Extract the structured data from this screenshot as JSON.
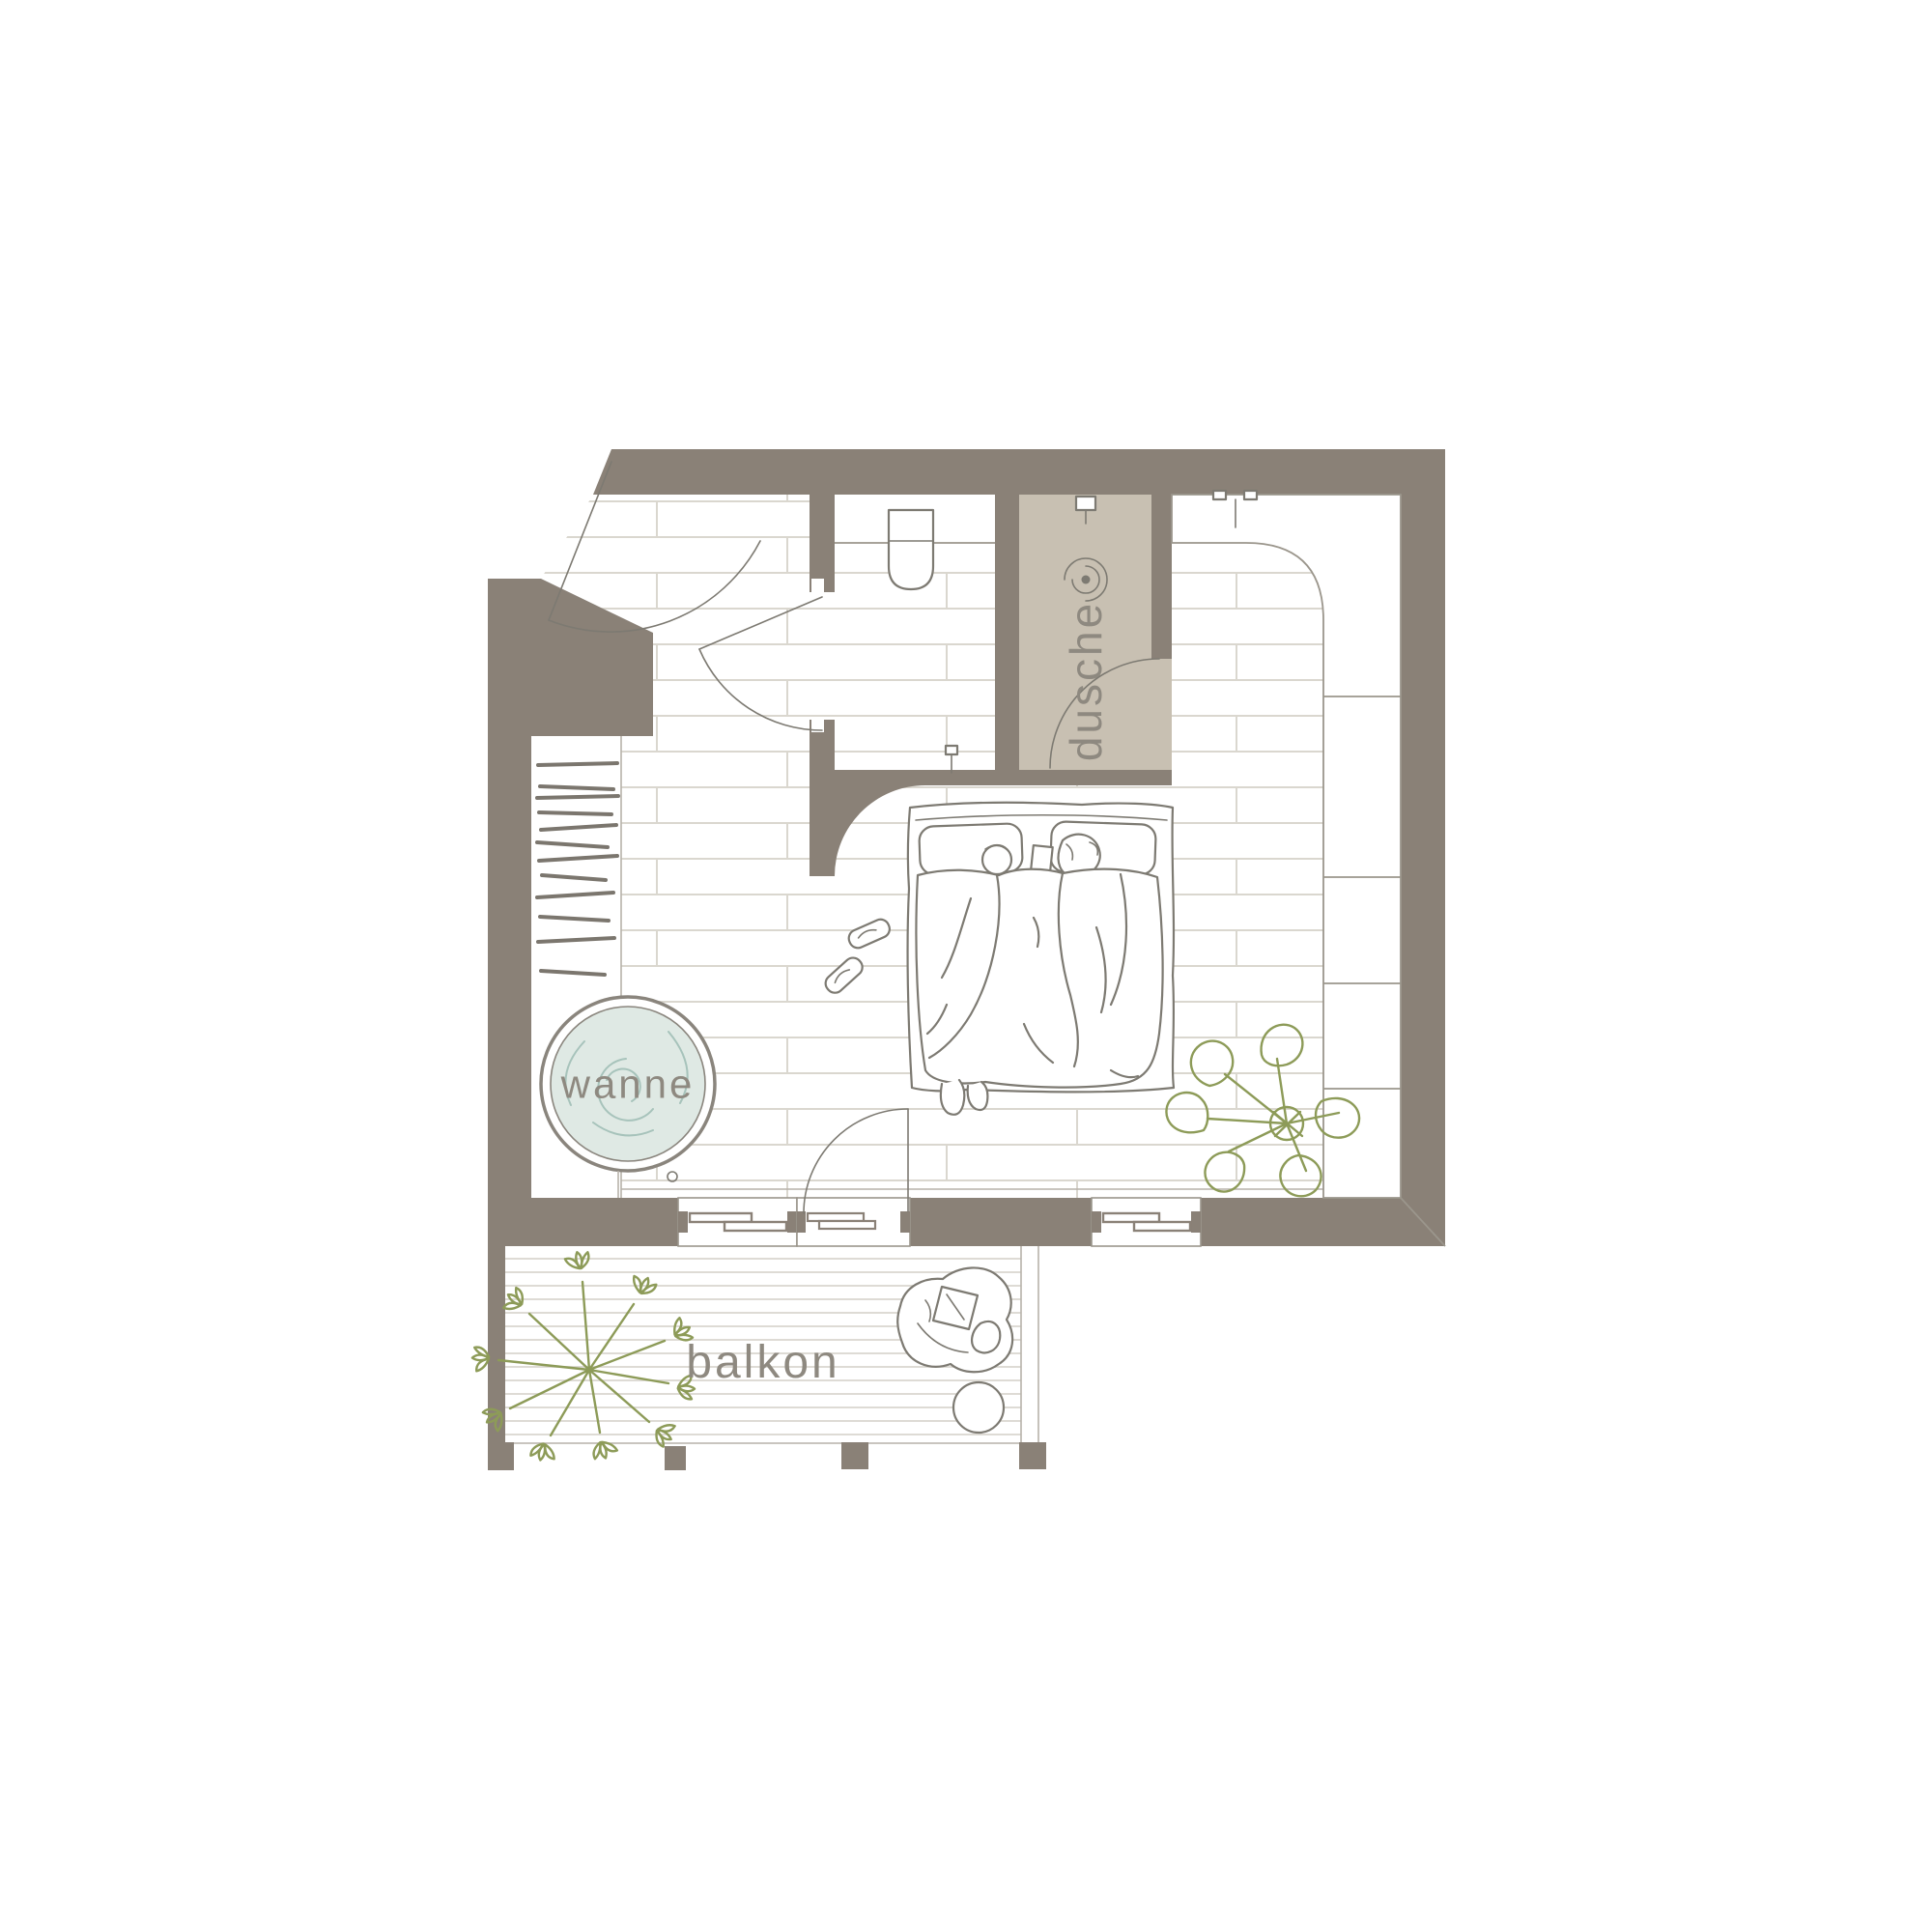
{
  "floor_plan": {
    "labels": {
      "shower": "dusche",
      "bathtub": "wanne",
      "balcony": "balkon"
    },
    "colors": {
      "wall": "#8a8177",
      "tile": "#c8c0b2",
      "water": "#dfe9e4",
      "water-line": "#a7c3bb",
      "plant": "#8d9b58",
      "ink": "#7d7a72",
      "plank": "#dad7cf",
      "deck": "#d9d6cf",
      "label": "#8e8980",
      "edge": "#9b968c",
      "faint": "#b7b2aa",
      "bg": "#ffffff"
    },
    "icons": {
      "shower_head": "shower-head-icon",
      "drain": "drain-spiral-icon",
      "faucet": "faucet-icon"
    }
  }
}
